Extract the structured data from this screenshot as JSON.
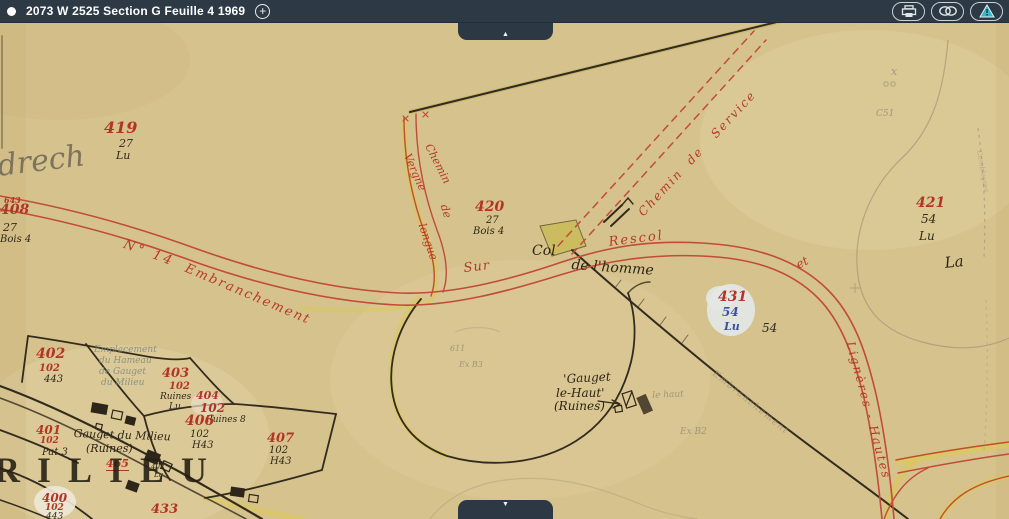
{
  "header": {
    "title": "2073 W 2525 Section G Feuille 4 1969",
    "add_button": "+",
    "icons": {
      "status": "white-dot",
      "add": "plus-circle",
      "print": "printer",
      "permalink": "chain-links",
      "report": "warning-triangle"
    }
  },
  "nav": {
    "scroll_up": "▲",
    "scroll_down": "▼"
  },
  "colors": {
    "header_bg": "#2d3a46",
    "map_bg": "#d6c28c",
    "road_red": "#c14c38",
    "label_red": "#b23427",
    "ink_black": "#2c2416",
    "pencil_gray": "#8d8672",
    "blue_ink": "#3e4f9f",
    "highlight_yellow": "#dcc94f",
    "alert_teal": "#35b6c9"
  },
  "map": {
    "labels": [
      {
        "text": "419",
        "x": 104,
        "y": 120,
        "cls": "rid",
        "fs": 16
      },
      {
        "text": "27",
        "x": 119,
        "y": 138,
        "cls": "bsub",
        "fs": 11
      },
      {
        "text": "Lu",
        "x": 116,
        "y": 150,
        "cls": "bsub",
        "fs": 11
      },
      {
        "text": "643",
        "x": 4,
        "y": 196,
        "cls": "rid",
        "fs": 8
      },
      {
        "text": "408",
        "x": 0,
        "y": 203,
        "cls": "rid",
        "fs": 14
      },
      {
        "text": "27",
        "x": 3,
        "y": 222,
        "cls": "bsub",
        "fs": 11
      },
      {
        "text": "Bois 4",
        "x": 0,
        "y": 235,
        "cls": "bsub",
        "fs": 10
      },
      {
        "text": "420",
        "x": 475,
        "y": 200,
        "cls": "rid",
        "fs": 14
      },
      {
        "text": "27",
        "x": 486,
        "y": 216,
        "cls": "bsub",
        "fs": 10
      },
      {
        "text": "Bois 4",
        "x": 473,
        "y": 227,
        "cls": "bsub",
        "fs": 10
      },
      {
        "text": "421",
        "x": 916,
        "y": 196,
        "cls": "rid",
        "fs": 14
      },
      {
        "text": "54",
        "x": 921,
        "y": 213,
        "cls": "bsub",
        "fs": 12
      },
      {
        "text": "Lu",
        "x": 919,
        "y": 230,
        "cls": "bsub",
        "fs": 12
      },
      {
        "text": "C51",
        "x": 876,
        "y": 110,
        "cls": "pencil",
        "fs": 9
      },
      {
        "text": "x",
        "x": 891,
        "y": 66,
        "cls": "pencil",
        "fs": 11
      },
      {
        "text": "431",
        "x": 718,
        "y": 290,
        "cls": "rid",
        "fs": 14
      },
      {
        "text": "54",
        "x": 722,
        "y": 306,
        "cls": "blue",
        "fs": 12
      },
      {
        "text": "Lu",
        "x": 724,
        "y": 321,
        "cls": "blue",
        "fs": 11
      },
      {
        "text": "54",
        "x": 762,
        "y": 322,
        "cls": "bsub",
        "fs": 12
      },
      {
        "text": "La",
        "x": 944,
        "y": 256,
        "cls": "ink",
        "fs": 15,
        "rot": -6
      },
      {
        "text": "Col",
        "x": 532,
        "y": 244,
        "cls": "ink",
        "fs": 14
      },
      {
        "text": "de l'homme",
        "x": 572,
        "y": 258,
        "cls": "ink",
        "fs": 14,
        "rot": 4
      },
      {
        "text": "Sur",
        "x": 463,
        "y": 262,
        "cls": "road",
        "fs": 13,
        "rot": -6,
        "ls": 1
      },
      {
        "text": "Rescol",
        "x": 608,
        "y": 236,
        "cls": "road",
        "fs": 13,
        "rot": -7,
        "ls": 2
      },
      {
        "text": "N° 14",
        "x": 126,
        "y": 238,
        "cls": "road",
        "fs": 13,
        "rot": 20,
        "ls": 3
      },
      {
        "text": "Embranchement",
        "x": 188,
        "y": 262,
        "cls": "road",
        "fs": 13,
        "rot": 23,
        "ls": 2
      },
      {
        "text": "et",
        "x": 794,
        "y": 260,
        "cls": "road",
        "fs": 12,
        "rot": -28
      },
      {
        "text": "Chemin  de   Service",
        "x": 636,
        "y": 210,
        "cls": "road",
        "fs": 12,
        "rot": -47,
        "ls": 2
      },
      {
        "text": "Chemin",
        "x": 433,
        "y": 142,
        "cls": "road",
        "fs": 11,
        "rot": 63
      },
      {
        "text": "de",
        "x": 449,
        "y": 203,
        "cls": "road",
        "fs": 11,
        "rot": 72
      },
      {
        "text": "Vergne",
        "x": 412,
        "y": 152,
        "cls": "road",
        "fs": 11,
        "rot": 66
      },
      {
        "text": "longue",
        "x": 427,
        "y": 222,
        "cls": "road",
        "fs": 11,
        "rot": 71
      },
      {
        "text": "Lignères - Hautes",
        "x": 856,
        "y": 340,
        "cls": "road",
        "fs": 12,
        "rot": 75,
        "ls": 2
      },
      {
        "text": "Embranchement",
        "x": 716,
        "y": 370,
        "cls": "pencil",
        "fs": 9,
        "rot": 39,
        "ls": 1.5,
        "op": 0.6
      },
      {
        "text": "402",
        "x": 36,
        "y": 347,
        "cls": "rid",
        "fs": 14
      },
      {
        "text": "102",
        "x": 39,
        "y": 364,
        "cls": "rid",
        "fs": 10
      },
      {
        "text": "443",
        "x": 44,
        "y": 375,
        "cls": "bsub",
        "fs": 10
      },
      {
        "text": "Emplacement",
        "x": 94,
        "y": 346,
        "cls": "pteal",
        "fs": 9
      },
      {
        "text": "du Hameau",
        "x": 99,
        "y": 357,
        "cls": "pteal",
        "fs": 9
      },
      {
        "text": "de Gauget",
        "x": 99,
        "y": 368,
        "cls": "pteal",
        "fs": 9
      },
      {
        "text": "du Milieu",
        "x": 101,
        "y": 379,
        "cls": "pteal",
        "fs": 9
      },
      {
        "text": "403",
        "x": 162,
        "y": 367,
        "cls": "rid",
        "fs": 13
      },
      {
        "text": "102",
        "x": 169,
        "y": 382,
        "cls": "rid",
        "fs": 10
      },
      {
        "text": "Ruines",
        "x": 160,
        "y": 393,
        "cls": "bsub",
        "fs": 9
      },
      {
        "text": "Lu",
        "x": 169,
        "y": 403,
        "cls": "bsub",
        "fs": 9
      },
      {
        "text": "404",
        "x": 196,
        "y": 390,
        "cls": "rid",
        "fs": 11
      },
      {
        "text": "102",
        "x": 200,
        "y": 402,
        "cls": "rid",
        "fs": 12
      },
      {
        "text": "Ruines 8",
        "x": 206,
        "y": 416,
        "cls": "bsub",
        "fs": 9
      },
      {
        "text": "406",
        "x": 185,
        "y": 414,
        "cls": "rid",
        "fs": 14
      },
      {
        "text": "102",
        "x": 190,
        "y": 430,
        "cls": "bsub",
        "fs": 10
      },
      {
        "text": "H43",
        "x": 192,
        "y": 441,
        "cls": "bsub",
        "fs": 10
      },
      {
        "text": "407",
        "x": 267,
        "y": 432,
        "cls": "rid",
        "fs": 13
      },
      {
        "text": "102",
        "x": 269,
        "y": 446,
        "cls": "bsub",
        "fs": 10
      },
      {
        "text": "H43",
        "x": 270,
        "y": 457,
        "cls": "bsub",
        "fs": 10
      },
      {
        "text": "401",
        "x": 36,
        "y": 424,
        "cls": "rid",
        "fs": 12
      },
      {
        "text": "102",
        "x": 40,
        "y": 437,
        "cls": "rid",
        "fs": 9
      },
      {
        "text": "Pat 3",
        "x": 42,
        "y": 448,
        "cls": "bsub",
        "fs": 10
      },
      {
        "text": "Gauget du Milieu",
        "x": 74,
        "y": 428,
        "cls": "ink",
        "fs": 11,
        "rot": 2
      },
      {
        "text": "(Ruines)",
        "x": 86,
        "y": 443,
        "cls": "ink",
        "fs": 11
      },
      {
        "text": "465",
        "x": 106,
        "y": 458,
        "cls": "rid u-red",
        "fs": 11
      },
      {
        "text": "402",
        "x": 151,
        "y": 464,
        "cls": "bsub",
        "fs": 7
      },
      {
        "text": "Lu",
        "x": 154,
        "y": 472,
        "cls": "bsub",
        "fs": 7
      },
      {
        "text": "RILIEU",
        "x": -6,
        "y": 452,
        "cls": "print",
        "fs": 36,
        "ls": 17
      },
      {
        "text": "400",
        "x": 42,
        "y": 492,
        "cls": "rid",
        "fs": 12
      },
      {
        "text": "102",
        "x": 45,
        "y": 504,
        "cls": "rid",
        "fs": 9
      },
      {
        "text": "443",
        "x": 46,
        "y": 513,
        "cls": "bsub",
        "fs": 9
      },
      {
        "text": "433",
        "x": 151,
        "y": 503,
        "cls": "rid",
        "fs": 13
      },
      {
        "text": "'Gauget",
        "x": 563,
        "y": 373,
        "cls": "ink",
        "fs": 12,
        "rot": -3
      },
      {
        "text": "le-Haut'",
        "x": 556,
        "y": 387,
        "cls": "ink",
        "fs": 12
      },
      {
        "text": "(Ruines)",
        "x": 554,
        "y": 400,
        "cls": "ink",
        "fs": 12
      },
      {
        "text": "le haut",
        "x": 652,
        "y": 392,
        "cls": "pencil",
        "fs": 9,
        "rot": -3
      },
      {
        "text": "611",
        "x": 450,
        "y": 345,
        "cls": "pencil",
        "fs": 8
      },
      {
        "text": "Ex B3",
        "x": 459,
        "y": 361,
        "cls": "pencil",
        "fs": 8
      },
      {
        "text": "Ex B2",
        "x": 680,
        "y": 428,
        "cls": "pencil",
        "fs": 9
      },
      {
        "text": "Cambleyres",
        "x": 982,
        "y": 150,
        "cls": "pencil",
        "fs": 7,
        "rot": 80,
        "op": 0.45
      },
      {
        "text": "drech",
        "x": -4,
        "y": 152,
        "cls": "cursive",
        "fs": 30,
        "rot": -7
      }
    ]
  }
}
